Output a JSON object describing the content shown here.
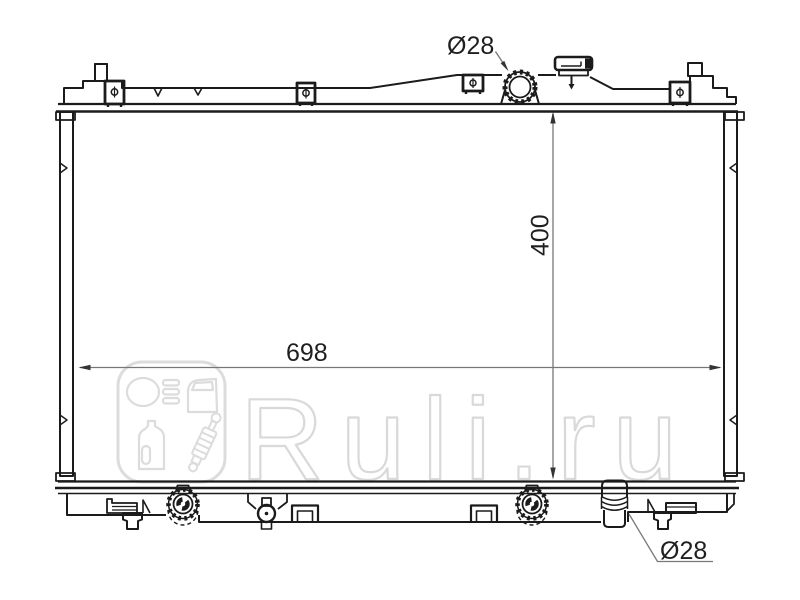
{
  "colors": {
    "background": "#ffffff",
    "line": "#1b1b1b",
    "dimension_line": "#777777",
    "dimension_text": "#1f1f1f",
    "watermark": "#dcdcdc",
    "watermark_text": "#d9d9d9"
  },
  "diagram": {
    "type": "technical-line-drawing",
    "subject": "Automotive engine-cooling radiator, front elevation with top tank, filler neck and cap, mounting clips, bottom tank fittings and outlet pipe",
    "annotations": {
      "filler_neck_diameter": "Ø28",
      "core_height": "400",
      "core_width": "698",
      "outlet_pipe_diameter": "Ø28"
    }
  },
  "watermark": {
    "text": "Ruli.ru",
    "logo_icons": [
      "headlight-icon",
      "car-door-icon",
      "oil-canister-icon",
      "shock-absorber-icon"
    ]
  }
}
